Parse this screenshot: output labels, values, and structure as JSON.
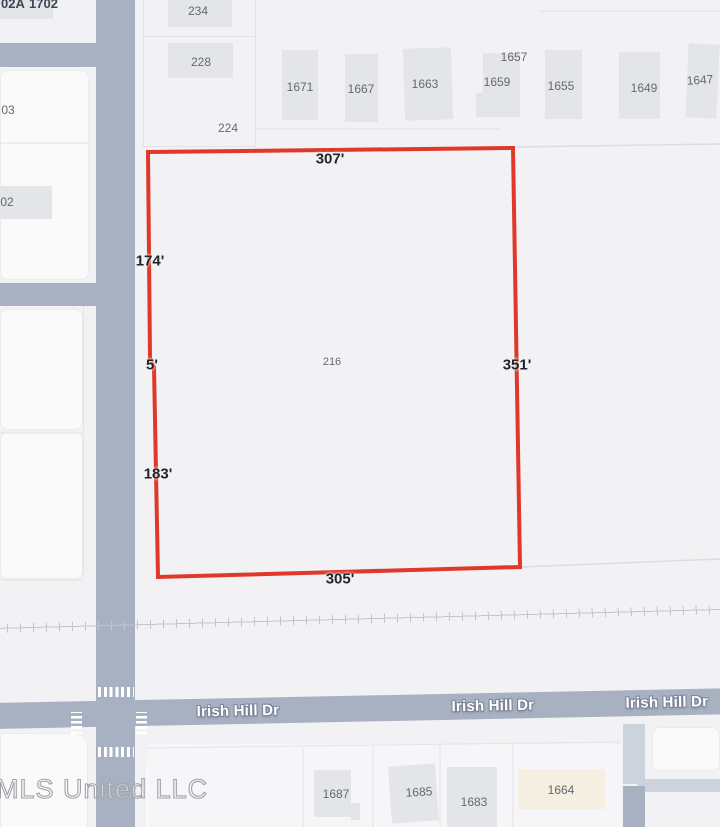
{
  "map": {
    "streets": {
      "rodenberg": "Rodenberg Ave",
      "roden_park": "Roden Park Dr",
      "stevens": "Stevens St",
      "irish_hill": "Irish Hill Dr"
    },
    "parcel_216": {
      "number": "216",
      "outline_color": "#df392c",
      "dimensions": {
        "top": "307'",
        "upper_left": "174'",
        "jog": "5'",
        "lower_left": "183'",
        "right": "351'",
        "bottom": "305'"
      }
    },
    "parcel_labels": {
      "234": "234",
      "228": "228",
      "224": "224",
      "1671": "1671",
      "1667": "1667",
      "1663": "1663",
      "1657": "1657",
      "1659": "1659",
      "1655": "1655",
      "1649": "1649",
      "1647": "1647",
      "1687": "1687",
      "1685": "1685",
      "1683": "1683",
      "1664": "1664"
    },
    "partial_labels": {
      "top_a": "02A",
      "top_b": "1702",
      "left_a": "03",
      "left_b": "02"
    },
    "watermark": "MLS United LLC",
    "colors": {
      "background": "#f2f2f4",
      "road": "#a8b1c1",
      "driveway": "#cdd3dc",
      "building": "#e3e5e9",
      "building_cream": "#f5efe1",
      "parcel_outline_red": "#df392c",
      "railroad": "#c5c5c8"
    }
  }
}
